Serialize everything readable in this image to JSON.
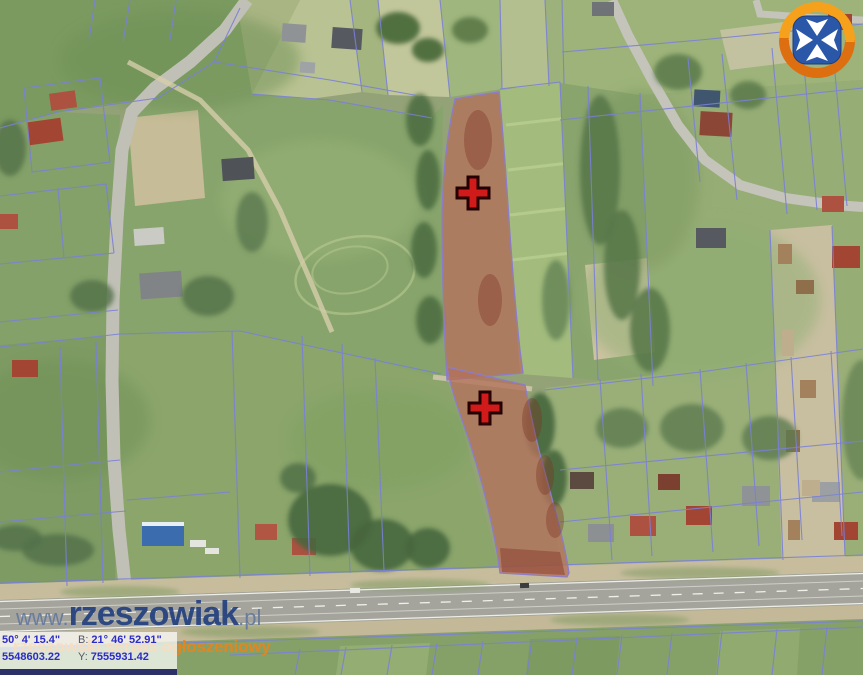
{
  "brand": {
    "watermark_prefix": "www.",
    "watermark_name": "rzeszowiak",
    "watermark_suffix": ".pl",
    "tagline": "rzeszowski serwis ogłoszeniowy",
    "watermark_color": "#23407f",
    "tagline_color": "#e8851f",
    "logo": {
      "name": "rzeszow-city-crest",
      "ring_top_color": "#f5a11c",
      "ring_bottom_color": "#dd6f10",
      "shield_color": "#2a57a8",
      "cross_color": "#ffffff"
    }
  },
  "map": {
    "kind": "aerial-orthophoto-with-cadastral-parcels",
    "parcel_line_color": "#7b80d8",
    "highlight_fill": "#b4715b",
    "highlight_outline": "#8d7cc8",
    "marker_color": "#d11a1a",
    "highlighted_parcel_count": 2,
    "markers": [
      {
        "id": "parcel-marker-1",
        "x": 473,
        "y": 193
      },
      {
        "id": "parcel-marker-2",
        "x": 485,
        "y": 408
      }
    ]
  },
  "coords_panel": {
    "geo_lat": "50° 4' 15.4\"",
    "geo_lon_label": "B:",
    "geo_lon": "21° 46' 52.91\"",
    "xy_x": "5548603.22",
    "xy_y_label": "Y:",
    "xy_y": "7555931.42"
  }
}
